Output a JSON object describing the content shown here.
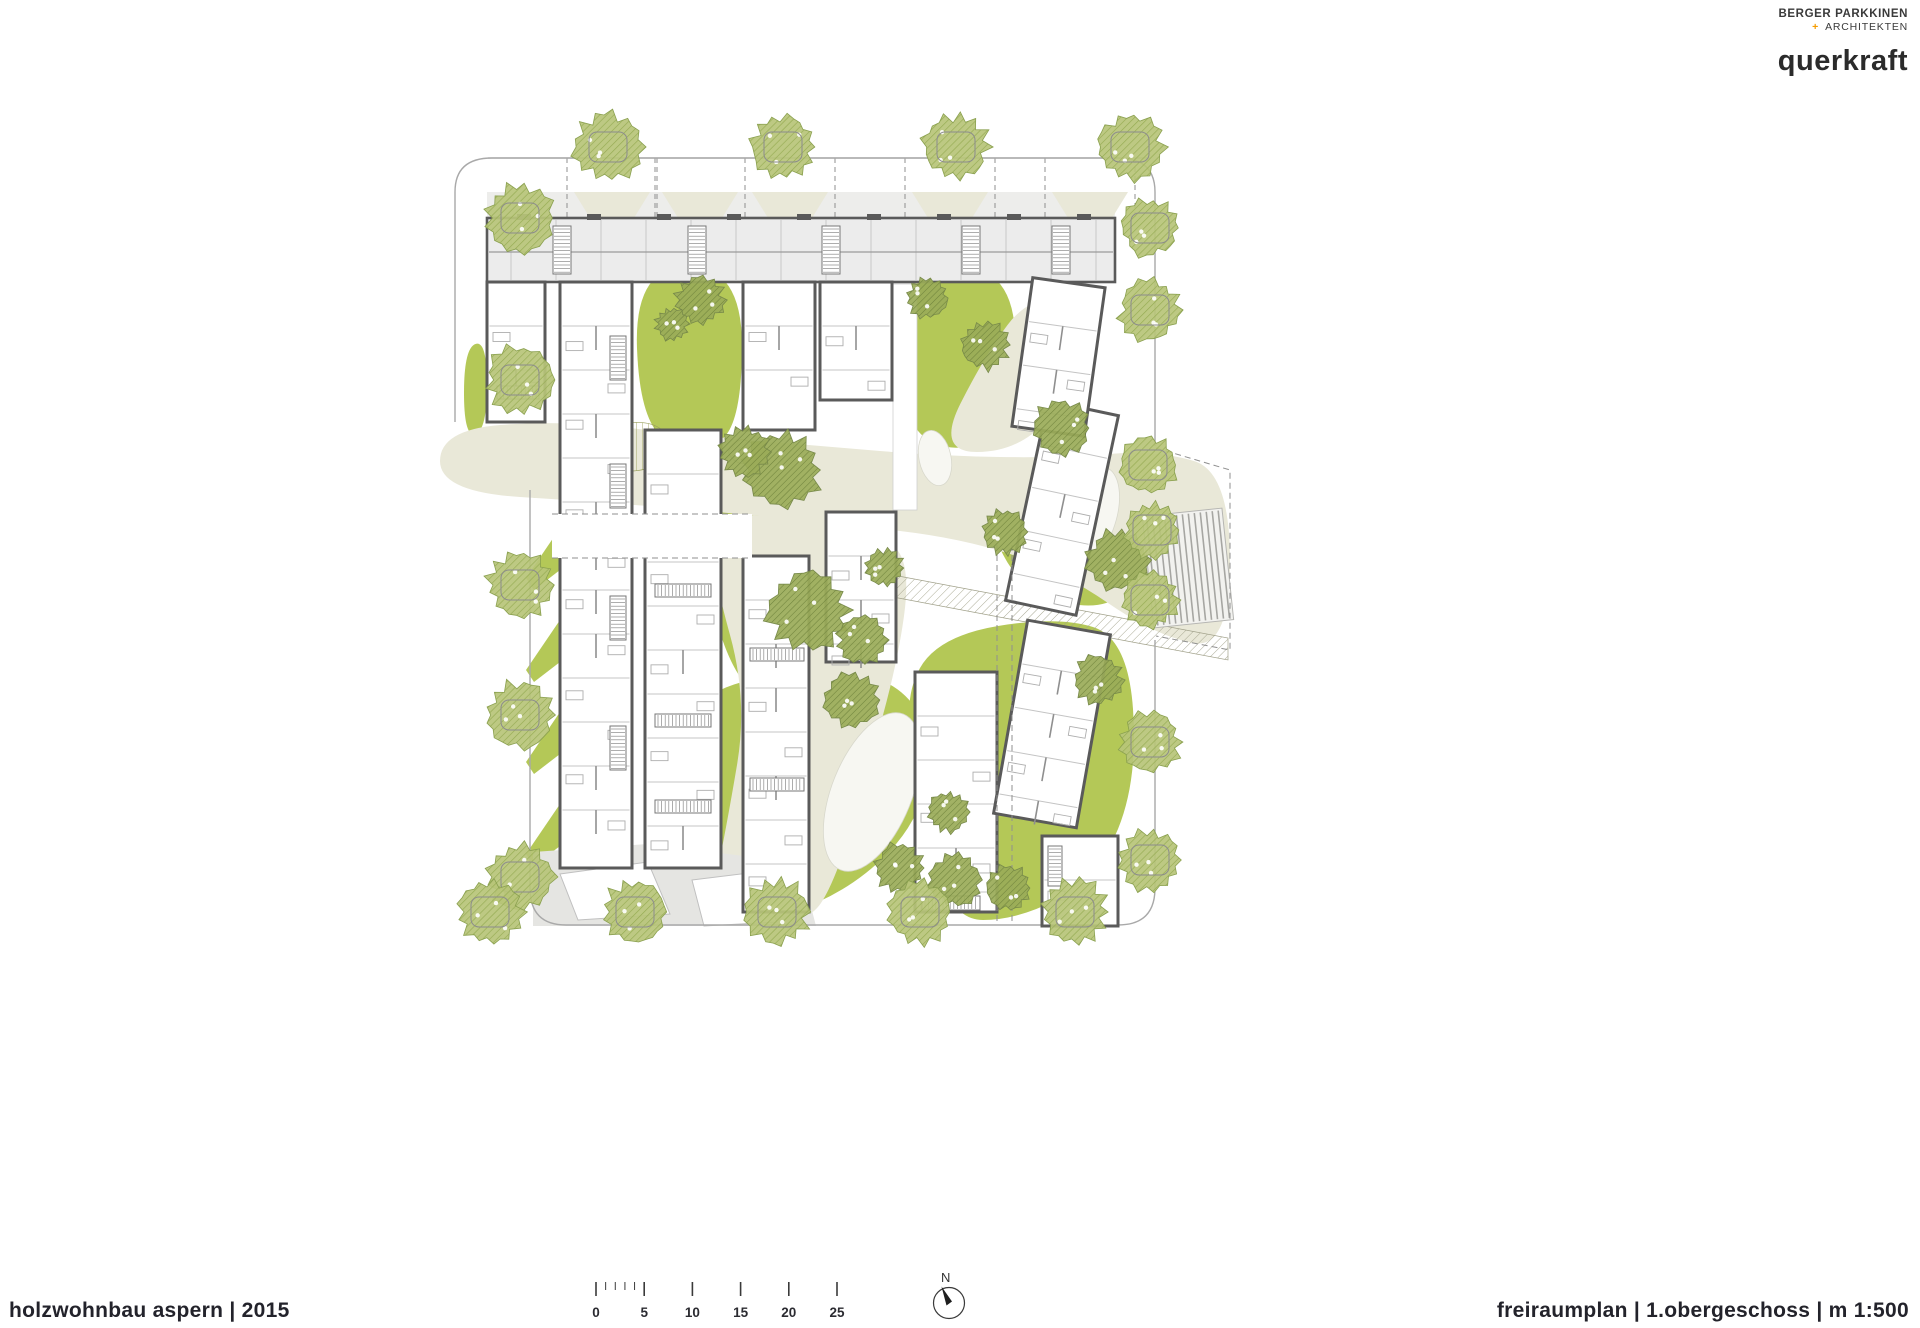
{
  "branding": {
    "firm1_line1": "BERGER PARKKINEN",
    "firm1_plus": "+",
    "firm1_line2": "ARCHITEKTEN",
    "firm2": "querkraft"
  },
  "footer": {
    "project_title": "holzwohnbau aspern  | 2015",
    "sheet_title": "freiraumplan | 1.obergeschoss | m 1:500"
  },
  "scale_bar": {
    "labels": [
      "0",
      "5",
      "10",
      "15",
      "20",
      "25"
    ],
    "origin_x": 596,
    "spacing_px": 48.2,
    "tick_y": 1282,
    "minor_per_major": 5
  },
  "north_arrow": {
    "label": "N",
    "cx": 949,
    "cy": 1303,
    "r": 15.5
  },
  "colors": {
    "green": "#b4c857",
    "beige": "#e9e8d8",
    "room_gray": "#ececec",
    "band_gray": "#ededeb",
    "wall": "#5a5a5a",
    "thin": "#c4c4c4",
    "boundary": "#a9a9a9",
    "street_tree": "#b7c478",
    "street_tree_hatch": "#95ab52",
    "court_tree": "#9aab58",
    "court_tree_hatch": "#6f833c",
    "path_gray": "#e5e5e2",
    "deck_line": "#a6a6a2",
    "dash": "#8f8f8f",
    "text_dark": "#2b2b31",
    "accent_orange": "#f59c00"
  },
  "plan": {
    "boundary_paths": [
      "M 455,422 L 455,192 Q 455,158 492,158 L 1118,158 Q 1155,158 1155,192 L 1155,446",
      "M 530,490 L 530,888 Q 530,925 566,925 L 1118,925 Q 1155,925 1155,888 L 1155,640"
    ],
    "street_line": {
      "x1": 488,
      "y1": 158,
      "x2": 1150,
      "y2": 158
    },
    "top_band": {
      "x": 487,
      "y": 192,
      "w": 628,
      "h": 26,
      "trapezoid_cx": [
        612,
        700,
        790,
        950,
        1090
      ],
      "trap_top_half": 38,
      "trap_bot_half": 22,
      "band_bottom": 218
    },
    "greens": [
      [
        [
          634,
          266
        ],
        [
          742,
          266
        ],
        [
          742,
          425
        ],
        [
          700,
          455
        ],
        [
          640,
          430
        ]
      ],
      [
        [
          896,
          266
        ],
        [
          1018,
          266
        ],
        [
          1012,
          430
        ],
        [
          950,
          455
        ],
        [
          900,
          420
        ]
      ],
      [
        [
          1000,
          470
        ],
        [
          1098,
          455
        ],
        [
          1138,
          520
        ],
        [
          1128,
          610
        ],
        [
          1030,
          600
        ],
        [
          985,
          525
        ]
      ],
      [
        [
          700,
          450
        ],
        [
          790,
          460
        ],
        [
          826,
          470
        ],
        [
          830,
          665
        ],
        [
          790,
          705
        ],
        [
          740,
          690
        ],
        [
          705,
          590
        ],
        [
          688,
          505
        ]
      ],
      [
        [
          688,
          690
        ],
        [
          826,
          668
        ],
        [
          900,
          682
        ],
        [
          936,
          742
        ],
        [
          918,
          822
        ],
        [
          858,
          884
        ],
        [
          778,
          920
        ],
        [
          700,
          920
        ],
        [
          678,
          800
        ]
      ],
      [
        [
          938,
          636
        ],
        [
          1058,
          616
        ],
        [
          1128,
          638
        ],
        [
          1138,
          780
        ],
        [
          1098,
          878
        ],
        [
          1018,
          920
        ],
        [
          948,
          920
        ],
        [
          926,
          796
        ],
        [
          902,
          700
        ]
      ],
      [
        [
          464,
          348
        ],
        [
          487,
          340
        ],
        [
          487,
          430
        ],
        [
          464,
          438
        ]
      ]
    ],
    "balcony_jags_x": [
      526,
      560
    ],
    "balcony_jags_y": [
      462,
      554,
      646,
      738,
      830
    ],
    "beiges": [
      [
        [
          440,
          430
        ],
        [
          560,
          420
        ],
        [
          700,
          436
        ],
        [
          820,
          446
        ],
        [
          940,
          456
        ],
        [
          1060,
          458
        ],
        [
          1158,
          450
        ],
        [
          1230,
          472
        ],
        [
          1230,
          650
        ],
        [
          1156,
          636
        ],
        [
          1060,
          570
        ],
        [
          960,
          538
        ],
        [
          840,
          524
        ],
        [
          720,
          512
        ],
        [
          600,
          502
        ],
        [
          440,
          492
        ]
      ],
      [
        [
          936,
          452
        ],
        [
          985,
          355
        ],
        [
          1030,
          295
        ],
        [
          1098,
          302
        ],
        [
          1075,
          390
        ],
        [
          1018,
          452
        ]
      ],
      [
        [
          712,
          512
        ],
        [
          820,
          520
        ],
        [
          890,
          536
        ],
        [
          910,
          572
        ],
        [
          898,
          660
        ],
        [
          868,
          770
        ],
        [
          836,
          880
        ],
        [
          806,
          926
        ],
        [
          706,
          926
        ],
        [
          726,
          830
        ],
        [
          748,
          700
        ],
        [
          712,
          570
        ]
      ]
    ],
    "white_blobs": [
      {
        "cx": 1090,
        "cy": 517,
        "rx": 26,
        "ry": 52,
        "rot": 18
      },
      {
        "cx": 872,
        "cy": 792,
        "rx": 40,
        "ry": 84,
        "rot": 22
      },
      {
        "cx": 935,
        "cy": 458,
        "rx": 16,
        "ry": 28,
        "rot": -12
      }
    ],
    "hatch_vline_blob": [
      [
        588,
        432
      ],
      [
        648,
        418
      ],
      [
        676,
        442
      ],
      [
        652,
        472
      ],
      [
        600,
        470
      ]
    ],
    "hatch_diag_band": [
      [
        845,
        566
      ],
      [
        1228,
        638
      ],
      [
        1228,
        660
      ],
      [
        845,
        588
      ]
    ],
    "hatch_diag_tri": [
      [
        1032,
        288
      ],
      [
        1098,
        288
      ],
      [
        1098,
        344
      ]
    ],
    "hatch_diag_blob": [
      [
        724,
        452
      ],
      [
        742,
        436
      ],
      [
        760,
        450
      ],
      [
        744,
        468
      ]
    ],
    "gray_path": [
      [
        533,
        852
      ],
      [
        648,
        844
      ],
      [
        744,
        856
      ],
      [
        802,
        872
      ],
      [
        816,
        926
      ],
      [
        533,
        926
      ]
    ],
    "gray_path_whites": [
      [
        [
          560,
          874
        ],
        [
          648,
          862
        ],
        [
          670,
          914
        ],
        [
          578,
          920
        ]
      ],
      [
        [
          692,
          880
        ],
        [
          757,
          872
        ],
        [
          777,
          922
        ],
        [
          704,
          926
        ]
      ]
    ],
    "slab": {
      "x": 487,
      "y": 218,
      "w": 628,
      "h": 64
    },
    "corridor": {
      "x": 893,
      "y": 284,
      "w": 24,
      "h": 226
    },
    "buildings": [
      {
        "x": 487,
        "y": 282,
        "w": 58,
        "h": 140,
        "rot": 0
      },
      {
        "x": 560,
        "y": 282,
        "w": 72,
        "h": 586,
        "rot": 0
      },
      {
        "x": 645,
        "y": 430,
        "w": 76,
        "h": 438,
        "rot": 0
      },
      {
        "x": 743,
        "y": 282,
        "w": 72,
        "h": 148,
        "rot": 0
      },
      {
        "x": 743,
        "y": 556,
        "w": 66,
        "h": 356,
        "rot": 0
      },
      {
        "x": 820,
        "y": 282,
        "w": 72,
        "h": 118,
        "rot": 0
      },
      {
        "x": 826,
        "y": 512,
        "w": 70,
        "h": 150,
        "rot": 0
      },
      {
        "x": 915,
        "y": 672,
        "w": 82,
        "h": 240,
        "rot": 0
      },
      {
        "x": 1010,
        "y": 626,
        "w": 84,
        "h": 196,
        "rot": 10
      },
      {
        "x": 1026,
        "y": 406,
        "w": 72,
        "h": 204,
        "rot": 12
      },
      {
        "x": 1042,
        "y": 836,
        "w": 76,
        "h": 90,
        "rot": 0
      },
      {
        "x": 1022,
        "y": 282,
        "w": 73,
        "h": 150,
        "rot": 8
      }
    ],
    "passage_band": {
      "x": 552,
      "y": 514,
      "w": 200,
      "h": 44
    },
    "stairs": [
      {
        "x": 553,
        "y": 226,
        "w": 18,
        "h": 48,
        "dir": "v"
      },
      {
        "x": 688,
        "y": 226,
        "w": 18,
        "h": 48,
        "dir": "v"
      },
      {
        "x": 822,
        "y": 226,
        "w": 18,
        "h": 48,
        "dir": "v"
      },
      {
        "x": 962,
        "y": 226,
        "w": 18,
        "h": 48,
        "dir": "v"
      },
      {
        "x": 1052,
        "y": 226,
        "w": 18,
        "h": 48,
        "dir": "v"
      },
      {
        "x": 610,
        "y": 336,
        "w": 16,
        "h": 44,
        "dir": "v"
      },
      {
        "x": 610,
        "y": 464,
        "w": 16,
        "h": 44,
        "dir": "v"
      },
      {
        "x": 610,
        "y": 596,
        "w": 16,
        "h": 44,
        "dir": "v"
      },
      {
        "x": 610,
        "y": 726,
        "w": 16,
        "h": 44,
        "dir": "v"
      },
      {
        "x": 655,
        "y": 584,
        "w": 56,
        "h": 13,
        "dir": "h"
      },
      {
        "x": 655,
        "y": 714,
        "w": 56,
        "h": 13,
        "dir": "h"
      },
      {
        "x": 655,
        "y": 800,
        "w": 56,
        "h": 13,
        "dir": "h"
      },
      {
        "x": 750,
        "y": 648,
        "w": 54,
        "h": 13,
        "dir": "h"
      },
      {
        "x": 750,
        "y": 778,
        "w": 54,
        "h": 13,
        "dir": "h"
      },
      {
        "x": 922,
        "y": 896,
        "w": 58,
        "h": 14,
        "dir": "h"
      },
      {
        "x": 1048,
        "y": 846,
        "w": 14,
        "h": 40,
        "dir": "v"
      },
      {
        "x": 497,
        "y": 386,
        "w": 42,
        "h": 13,
        "dir": "h"
      }
    ],
    "deck": {
      "x": 1148,
      "y": 512,
      "w": 80,
      "h": 112,
      "rot": -6
    },
    "dash_lines": [
      [
        997,
        545,
        997,
        924
      ],
      [
        1012,
        545,
        1012,
        924
      ],
      [
        552,
        514,
        752,
        514
      ],
      [
        552,
        558,
        752,
        558
      ]
    ],
    "dash_poly": [
      [
        1156,
        448
      ],
      [
        1230,
        470
      ],
      [
        1230,
        650
      ],
      [
        1156,
        636
      ]
    ],
    "trees_street": [
      {
        "x": 608,
        "y": 147,
        "r": 33
      },
      {
        "x": 783,
        "y": 147,
        "r": 31
      },
      {
        "x": 956,
        "y": 147,
        "r": 32
      },
      {
        "x": 1130,
        "y": 147,
        "r": 33
      },
      {
        "x": 520,
        "y": 218,
        "r": 34
      },
      {
        "x": 520,
        "y": 380,
        "r": 33
      },
      {
        "x": 520,
        "y": 585,
        "r": 32
      },
      {
        "x": 520,
        "y": 715,
        "r": 34
      },
      {
        "x": 520,
        "y": 877,
        "r": 33
      },
      {
        "x": 1150,
        "y": 228,
        "r": 28
      },
      {
        "x": 1150,
        "y": 310,
        "r": 30
      },
      {
        "x": 1148,
        "y": 465,
        "r": 28
      },
      {
        "x": 1152,
        "y": 530,
        "r": 27
      },
      {
        "x": 1150,
        "y": 600,
        "r": 28
      },
      {
        "x": 1150,
        "y": 742,
        "r": 30
      },
      {
        "x": 1150,
        "y": 860,
        "r": 30
      },
      {
        "x": 490,
        "y": 912,
        "r": 32
      },
      {
        "x": 635,
        "y": 912,
        "r": 31
      },
      {
        "x": 777,
        "y": 912,
        "r": 32
      },
      {
        "x": 920,
        "y": 912,
        "r": 31
      },
      {
        "x": 1075,
        "y": 912,
        "r": 32
      }
    ],
    "trees_court": [
      {
        "x": 700,
        "y": 300,
        "r": 24
      },
      {
        "x": 672,
        "y": 324,
        "r": 16
      },
      {
        "x": 928,
        "y": 298,
        "r": 20
      },
      {
        "x": 985,
        "y": 345,
        "r": 24
      },
      {
        "x": 1062,
        "y": 428,
        "r": 28
      },
      {
        "x": 1118,
        "y": 560,
        "r": 30
      },
      {
        "x": 1005,
        "y": 532,
        "r": 22
      },
      {
        "x": 783,
        "y": 470,
        "r": 38
      },
      {
        "x": 745,
        "y": 452,
        "r": 24
      },
      {
        "x": 808,
        "y": 610,
        "r": 40
      },
      {
        "x": 852,
        "y": 700,
        "r": 27
      },
      {
        "x": 862,
        "y": 640,
        "r": 24
      },
      {
        "x": 885,
        "y": 568,
        "r": 18
      },
      {
        "x": 900,
        "y": 868,
        "r": 24
      },
      {
        "x": 955,
        "y": 880,
        "r": 26
      },
      {
        "x": 1008,
        "y": 888,
        "r": 22
      },
      {
        "x": 948,
        "y": 812,
        "r": 20
      },
      {
        "x": 1098,
        "y": 680,
        "r": 24
      }
    ]
  }
}
